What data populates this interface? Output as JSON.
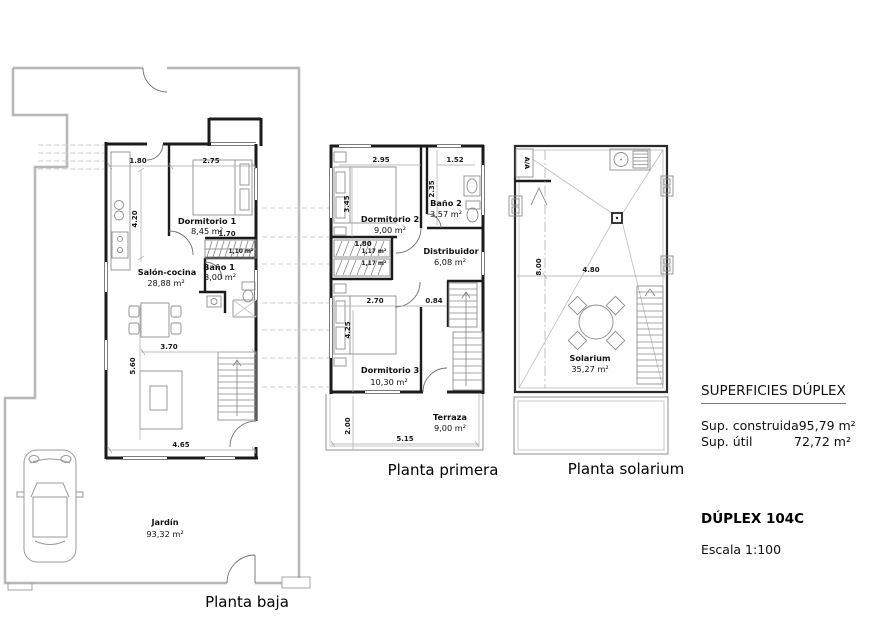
{
  "info_panel": {
    "surfaces_heading": "SUPERFICIES DÚPLEX",
    "surface_rows": [
      {
        "label": "Sup. construida",
        "value": "95,79 m²"
      },
      {
        "label": "Sup. útil",
        "value": "72,72 m²"
      }
    ],
    "unit_name": "DÚPLEX 104C",
    "scale": "Escala 1:100"
  },
  "plans": {
    "baja": {
      "title": "Planta baja",
      "rooms": [
        {
          "name": "Dormitorio 1",
          "area": "8,45 m²"
        },
        {
          "name": "Baño 1",
          "area": "3,00 m²"
        },
        {
          "name": "Salón-cocina",
          "area": "28,88 m²"
        },
        {
          "name": "Jardín",
          "area": "93,32 m²"
        }
      ],
      "stair_area_label": "1,10 m²",
      "dims": {
        "w_entry": "1.80",
        "w_dorm1": "2.75",
        "h_kitchen": "4.20",
        "w_stairs": "1.70",
        "w_living": "3.70",
        "h_living": "5.60",
        "w_house": "4.65"
      }
    },
    "primera": {
      "title": "Planta primera",
      "rooms": [
        {
          "name": "Dormitorio 2",
          "area": "9,00 m²"
        },
        {
          "name": "Baño 2",
          "area": "3,57 m²"
        },
        {
          "name": "Distribuidor",
          "area": "6,08 m²"
        },
        {
          "name": "Dormitorio 3",
          "area": "10,30 m²"
        },
        {
          "name": "Terraza",
          "area": "9,00 m²"
        }
      ],
      "stair_flight_labels": [
        "1,17 m²",
        "1,17 m²"
      ],
      "dims": {
        "w_dorm2": "2.95",
        "w_bath2": "1.52",
        "h_dorm2": "3.45",
        "h_bath2": "2.35",
        "w_stairs": "1.80",
        "w_dorm3": "2.70",
        "w_hall": "0.84",
        "h_dorm3": "4.25",
        "h_terraza": "2.00",
        "w_floor": "5.15"
      }
    },
    "solarium": {
      "title": "Planta solarium",
      "rooms": [
        {
          "name": "Solarium",
          "area": "35,27 m²"
        }
      ],
      "ac_label": "A/A",
      "dims": {
        "h_solarium": "8.00",
        "w_solarium": "4.80"
      }
    }
  }
}
